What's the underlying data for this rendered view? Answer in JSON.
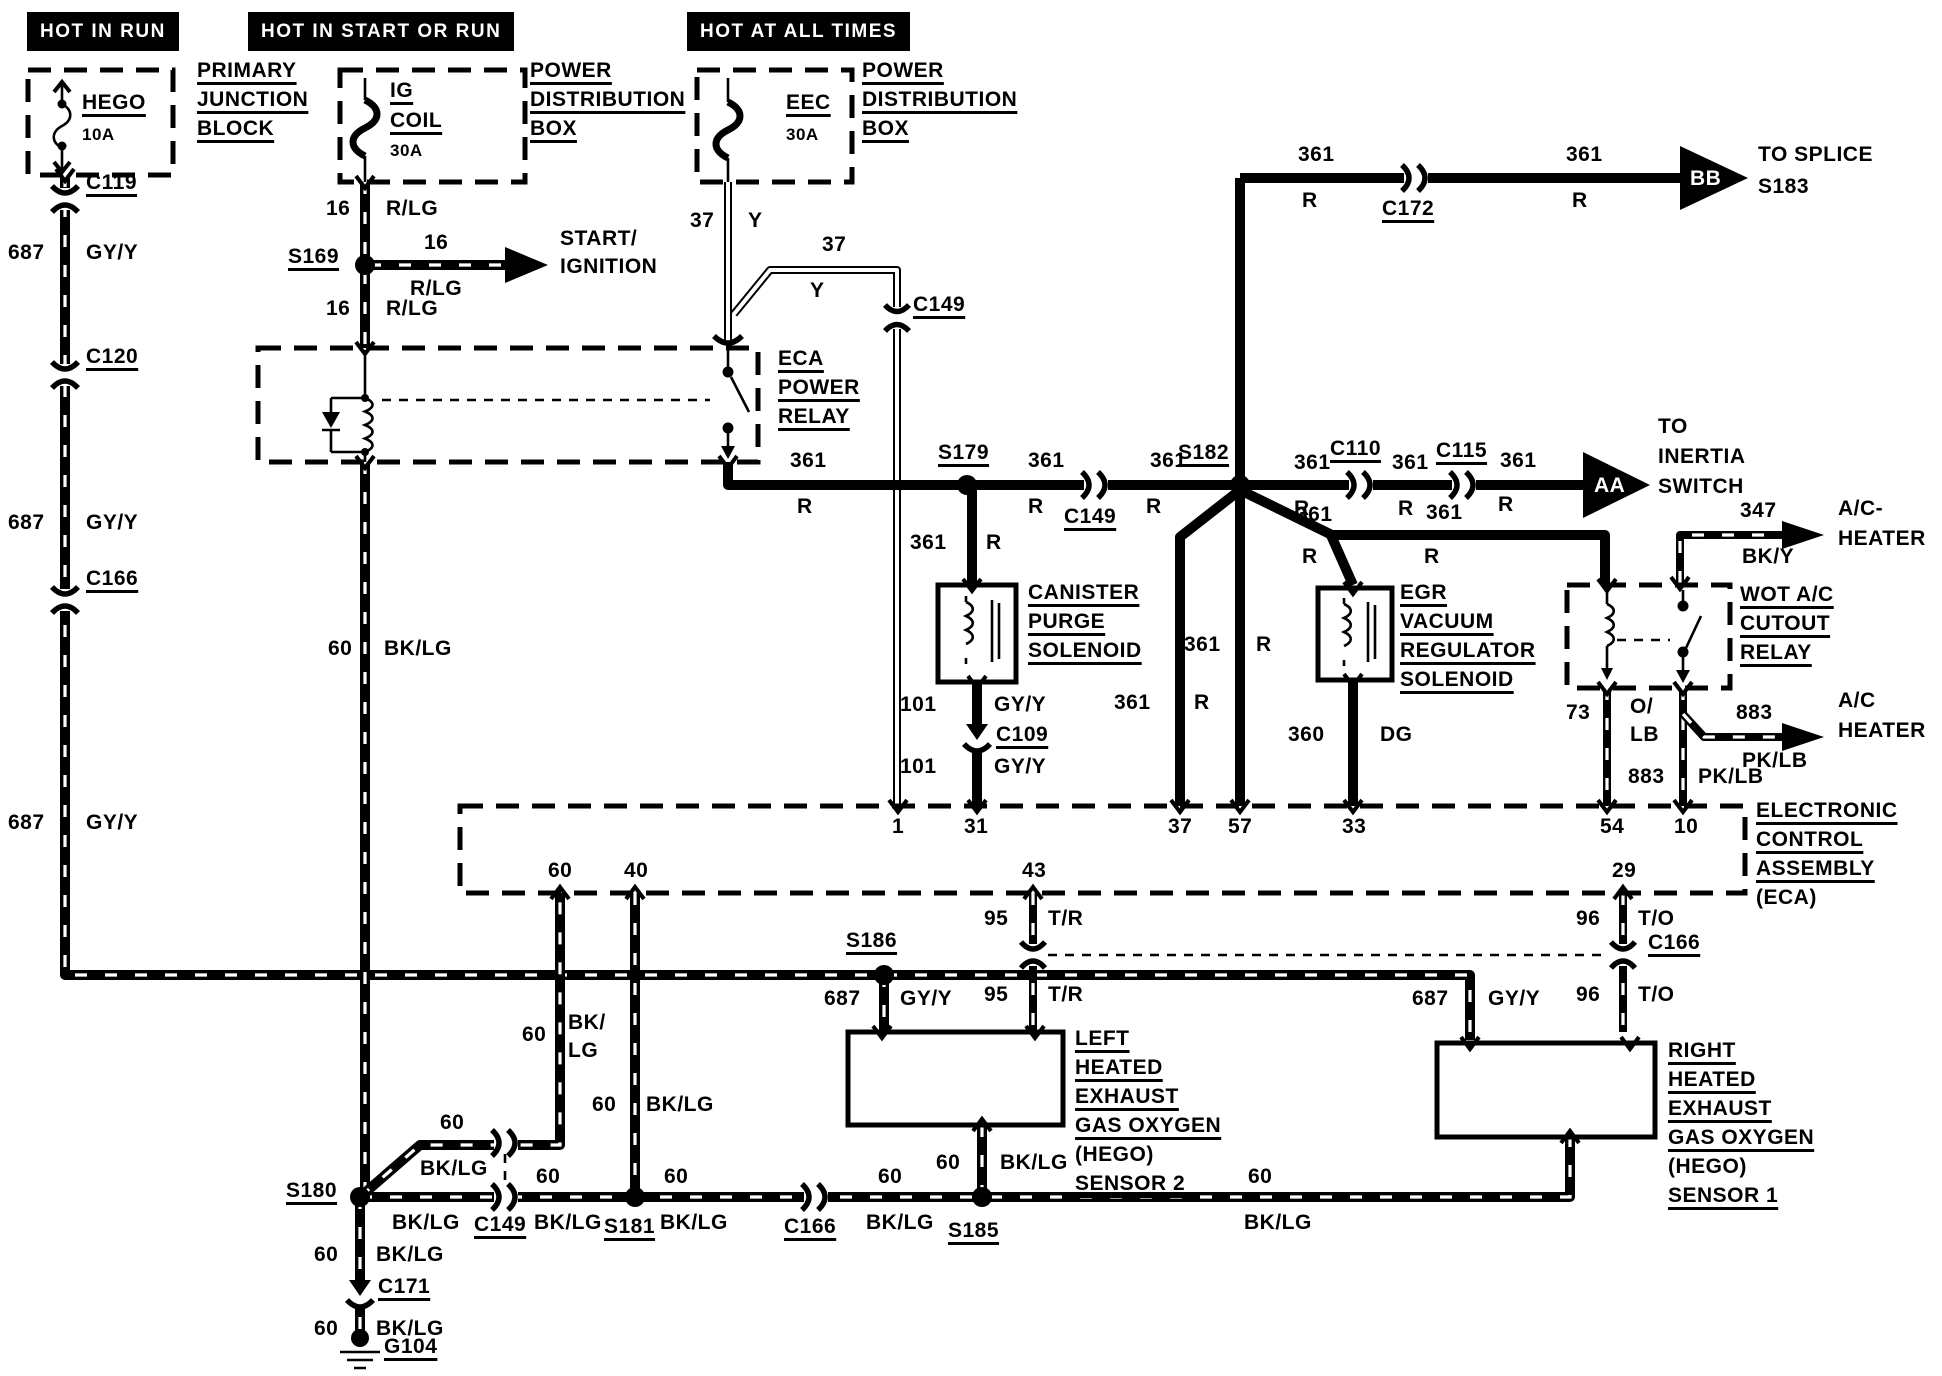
{
  "banners": {
    "hot_in_run": "HOT IN RUN",
    "hot_in_start_or_run": "HOT IN START OR RUN",
    "hot_at_all_times": "HOT AT ALL TIMES"
  },
  "fuses": {
    "hego": {
      "name": "HEGO",
      "rating": "10A"
    },
    "ig_coil": {
      "l1": "IG",
      "l2": "COIL",
      "rating": "30A"
    },
    "eec": {
      "name": "EEC",
      "rating": "30A"
    }
  },
  "blocks": {
    "primary_junction_block": {
      "l1": "PRIMARY",
      "l2": "JUNCTION",
      "l3": "BLOCK"
    },
    "power_dist_box": {
      "l1": "POWER",
      "l2": "DISTRIBUTION",
      "l3": "BOX"
    },
    "eca_power_relay": {
      "l1": "ECA",
      "l2": "POWER",
      "l3": "RELAY"
    },
    "canister_purge": {
      "l1": "CANISTER",
      "l2": "PURGE",
      "l3": "SOLENOID"
    },
    "egr_solenoid": {
      "l1": "EGR",
      "l2": "VACUUM",
      "l3": "REGULATOR",
      "l4": "SOLENOID"
    },
    "wot_relay": {
      "l1": "WOT A/C",
      "l2": "CUTOUT",
      "l3": "RELAY"
    },
    "eca": {
      "l1": "ELECTRONIC",
      "l2": "CONTROL",
      "l3": "ASSEMBLY",
      "l4": "(ECA)"
    },
    "left_hego": {
      "l1": "LEFT",
      "l2": "HEATED",
      "l3": "EXHAUST",
      "l4": "GAS OXYGEN",
      "l5": "(HEGO)",
      "l6": "SENSOR 2"
    },
    "right_hego": {
      "l1": "RIGHT",
      "l2": "HEATED",
      "l3": "EXHAUST",
      "l4": "GAS OXYGEN",
      "l5": "(HEGO)",
      "l6": "SENSOR 1"
    }
  },
  "wires": {
    "w687": {
      "num": "687",
      "color": "GY/Y"
    },
    "w16": {
      "num": "16",
      "color": "R/LG"
    },
    "w37": {
      "num": "37",
      "color": "Y"
    },
    "w361": {
      "num": "361",
      "color": "R"
    },
    "w101": {
      "num": "101",
      "color": "GY/Y"
    },
    "w360": {
      "num": "360",
      "color": "DG"
    },
    "w60": {
      "num": "60",
      "color": "BK/LG",
      "color_l1": "BK/",
      "color_l2": "LG"
    },
    "w95": {
      "num": "95",
      "color": "T/R"
    },
    "w96": {
      "num": "96",
      "color": "T/O"
    },
    "w73": {
      "num": "73",
      "color_l1": "O/",
      "color_l2": "LB"
    },
    "w883": {
      "num": "883",
      "color": "PK/LB"
    },
    "w347": {
      "num": "347",
      "color": "BK/Y"
    }
  },
  "connectors": {
    "c119": "C119",
    "c120": "C120",
    "c166": "C166",
    "c109": "C109",
    "c149": "C149",
    "c171": "C171",
    "c172": "C172",
    "c110": "C110",
    "c115": "C115"
  },
  "splices": {
    "s169": "S169",
    "s179": "S179",
    "s180": "S180",
    "s181": "S181",
    "s182": "S182",
    "s185": "S185",
    "s186": "S186"
  },
  "grounds": {
    "g104": "G104"
  },
  "eca_pins": {
    "p1": "1",
    "p31": "31",
    "p37": "37",
    "p57": "57",
    "p33": "33",
    "p54": "54",
    "p10": "10",
    "p60": "60",
    "p40": "40",
    "p43": "43",
    "p29": "29"
  },
  "destinations": {
    "start_ignition": {
      "l1": "START/",
      "l2": "IGNITION"
    },
    "to_splice": {
      "l1": "TO SPLICE",
      "l2": "S183"
    },
    "inertia": {
      "l1": "TO",
      "l2": "INERTIA",
      "l3": "SWITCH"
    },
    "ac_heater_top": {
      "l1": "A/C-",
      "l2": "HEATER"
    },
    "ac_heater_bottom": {
      "l1": "A/C",
      "l2": "HEATER"
    },
    "arrow_bb": "BB",
    "arrow_aa": "AA"
  }
}
